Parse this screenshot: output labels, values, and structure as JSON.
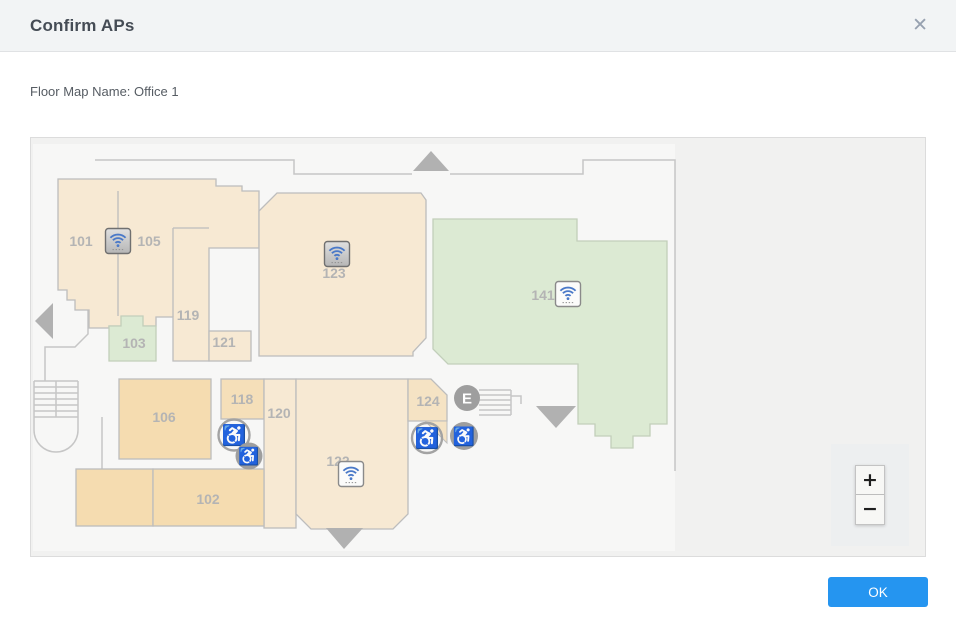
{
  "dialog": {
    "title": "Confirm APs",
    "close_icon": "✕",
    "floor_map_label": "Floor Map Name: Office 1",
    "ok_label": "OK"
  },
  "map": {
    "floor_map_name": "Office 1",
    "rooms": {
      "r101": "101",
      "r102": "102",
      "r103": "103",
      "r105": "105",
      "r106": "106",
      "r118": "118",
      "r119": "119",
      "r120": "120",
      "r121": "121",
      "r122": "122",
      "r123": "123",
      "r124": "124",
      "r141": "141"
    },
    "elevator_label": "E",
    "wheelchair_icon": "♿",
    "aps": [
      {
        "room": "105",
        "style": "gray"
      },
      {
        "room": "123",
        "style": "gray"
      },
      {
        "room": "141",
        "style": "white"
      },
      {
        "room": "122",
        "style": "white"
      }
    ],
    "zoom_in": "+",
    "zoom_out": "−",
    "colors": {
      "room_tan_light": "#f7e9d3",
      "room_tan_dark": "#f5dcb0",
      "room_green": "#dcead3",
      "wall_gray": "#bdbdbd",
      "accent_blue": "#2595f0",
      "ap_wifi_blue": "#4a79c8"
    }
  }
}
